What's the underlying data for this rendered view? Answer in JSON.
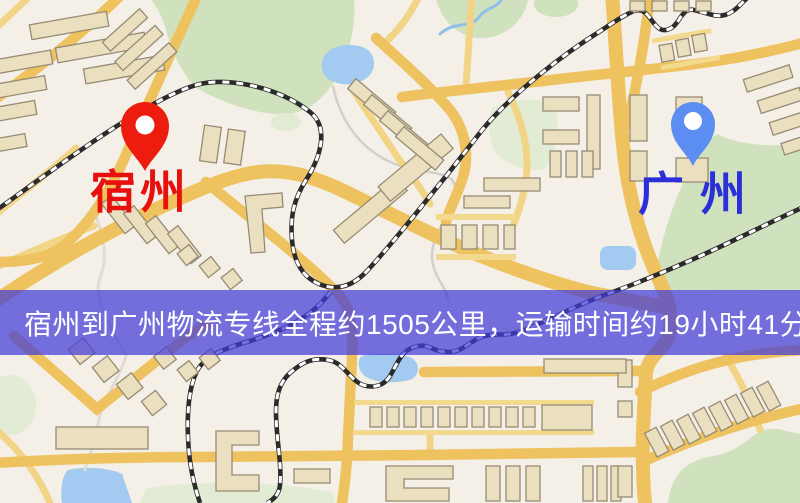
{
  "map_view": {
    "origin": {
      "label": "宿州",
      "label_color": "#e8100c",
      "pin_color": "#ed1c0e"
    },
    "destination": {
      "label": "广州",
      "label_color": "#2a2fd8",
      "pin_color": "#5b8df2"
    },
    "banner": {
      "text": "宿州到广州物流专线全程约1505公里，运输时间约19小时41分钟.",
      "text_color": "#ffffff",
      "background_color": "#423cd8"
    },
    "route_facts": {
      "distance_km": 1505,
      "duration_hours": 19,
      "duration_minutes": 41
    },
    "palette": {
      "background": "#f4efe7",
      "road": "#eec25e",
      "road_minor": "#f2d486",
      "building_fill": "#eadfbf",
      "building_stroke": "#978b74",
      "park": "#cfe2bd",
      "water": "#a3caf0",
      "railway": "#2b2b2b",
      "banner_overlay": "rgba(66,60,216,0.72)"
    }
  }
}
